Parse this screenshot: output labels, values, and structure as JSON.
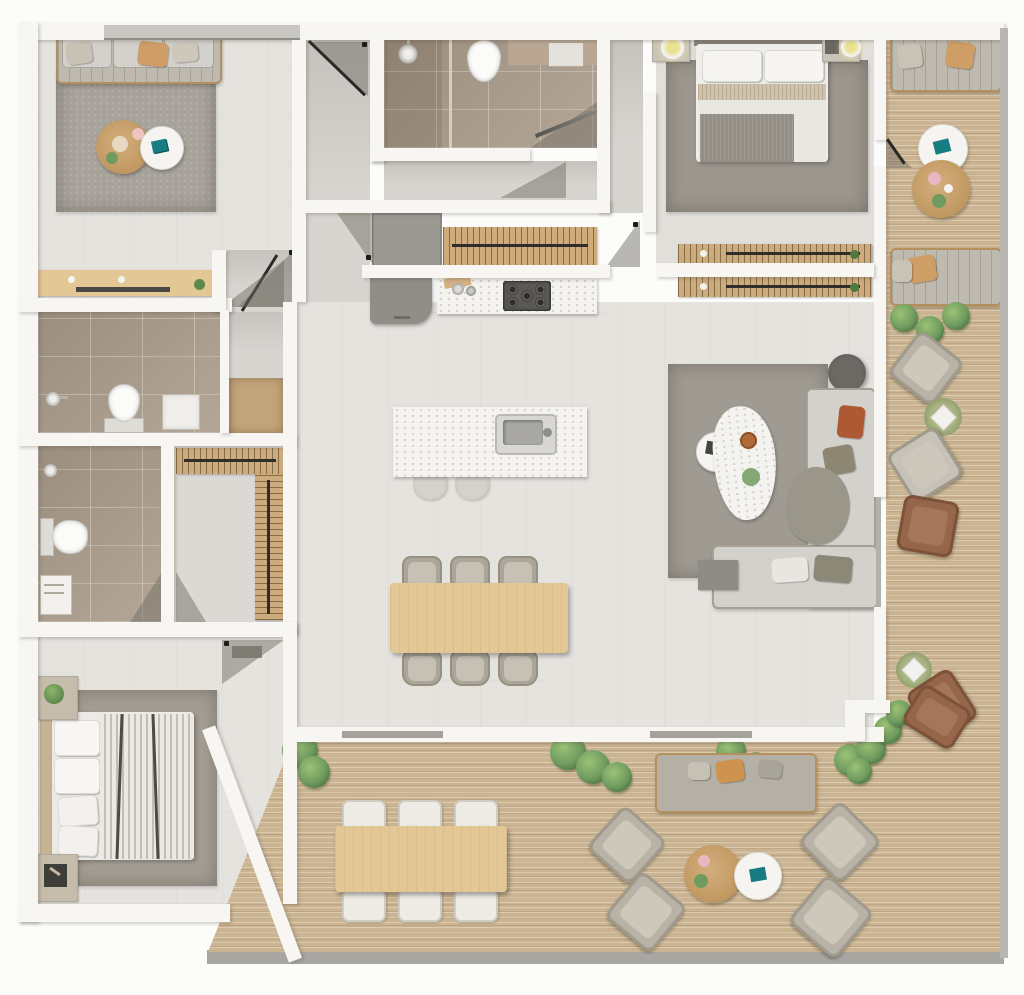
{
  "meta": {
    "title": "Apartment floor plan — top-down 3D render",
    "note": "photorealistic rendered plan, no visible text labels"
  },
  "palette": {
    "wall": "#f7f6f3",
    "floor": "#e5e3de",
    "floor_dark": "#d7d5d0",
    "tile": "#aea08f",
    "deck": "#cbb491",
    "rug": "#a7a29a",
    "sofa": "#bfbab0",
    "sofa_light": "#d3d1cb",
    "marble": "#f4f3f0",
    "wood": "#cdab7c",
    "wood_light": "#e3c795",
    "accent_tan": "#cf9d66",
    "accent_rust": "#ad5a34",
    "accent_olive": "#8c8672",
    "accent_teal": "#177d82",
    "plant": "#6f9b5f",
    "glass": "#b3b1ac"
  },
  "rooms": {
    "sitting_room": {
      "label": "Sitting room",
      "furniture": [
        "three-seat sofa",
        "area rug",
        "round wooden coffee table",
        "round white side table",
        "entry console with hooks"
      ]
    },
    "corridor": {
      "label": "Entry corridor",
      "furniture": [
        "entry door"
      ]
    },
    "bathroom_main": {
      "label": "Main bathroom",
      "furniture": [
        "walk-in shower",
        "toilet",
        "vanity with mirror"
      ]
    },
    "hallway": {
      "label": "Hallway",
      "furniture": [
        "interior doors"
      ]
    },
    "closet_hall": {
      "label": "Hall closet",
      "furniture": [
        "tall cabinet",
        "wardrobe rail"
      ]
    },
    "kitchen": {
      "label": "Kitchen",
      "furniture": [
        "wall counter with gas hob",
        "tall grey unit",
        "marble island with sink",
        "two bar stools"
      ]
    },
    "dining": {
      "label": "Dining area",
      "furniture": [
        "wooden table",
        "six chairs"
      ]
    },
    "living_room": {
      "label": "Living room",
      "furniture": [
        "L-shaped sectional sofa",
        "organic marble coffee table",
        "round side table",
        "floor lamp",
        "grey side table",
        "area rug"
      ]
    },
    "bedroom_master": {
      "label": "Master bedroom",
      "furniture": [
        "double bed",
        "two nightstands with lamps",
        "area rug",
        "double-sided wardrobe rails"
      ]
    },
    "bathroom_2": {
      "label": "Second bathroom",
      "furniture": [
        "toilet",
        "shower head",
        "washbasin frame"
      ]
    },
    "bathroom_3": {
      "label": "Third bathroom",
      "furniture": [
        "toilet",
        "shower head",
        "washbasin cabinet"
      ]
    },
    "walk_in_closet": {
      "label": "Walk-in closet",
      "furniture": [
        "L-shaped wardrobe rails"
      ]
    },
    "bedroom_2": {
      "label": "Second bedroom",
      "furniture": [
        "double bed with striped duvet",
        "two nightstands",
        "plant",
        "area rug"
      ]
    },
    "balcony": {
      "label": "Side balcony",
      "furniture": [
        "two loveseats",
        "round wooden table",
        "round white table",
        "lounge chairs",
        "leather chairs",
        "planter stools",
        "potted plants"
      ]
    },
    "terrace": {
      "label": "Main terrace",
      "furniture": [
        "outdoor dining table with six chairs",
        "outdoor sofa",
        "four lounge armchairs",
        "round wooden table",
        "round white table",
        "brown lounger",
        "potted plants"
      ]
    }
  }
}
